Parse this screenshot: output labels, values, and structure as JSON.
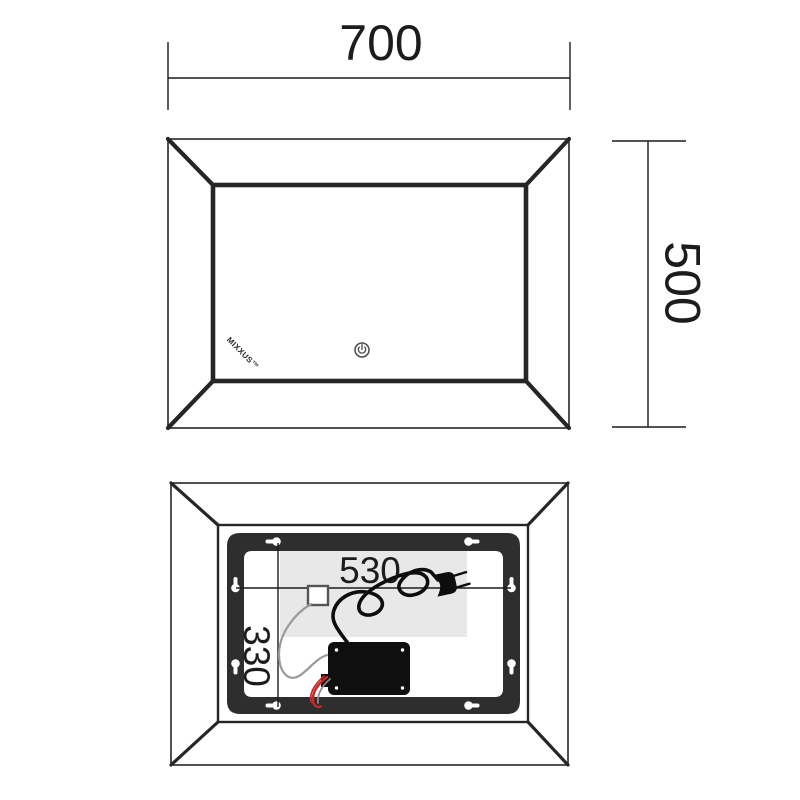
{
  "front_view": {
    "width_dimension": "700",
    "height_dimension": "500",
    "brand_logo": "MIXXUS™",
    "power_icon": "power-standby-symbol"
  },
  "back_view": {
    "mounting_width_dimension": "530",
    "mounting_height_dimension": "330",
    "keyhole_count": "8"
  },
  "colors": {
    "line": "#262626",
    "mount_frame": "#2e2e2e",
    "led_strip": "#e8e8e8",
    "driver_box": "#0f0f0f",
    "cord": "#0d0d0d",
    "low_voltage_cable": "#9a9a9a",
    "wire_red": "#c62828"
  }
}
